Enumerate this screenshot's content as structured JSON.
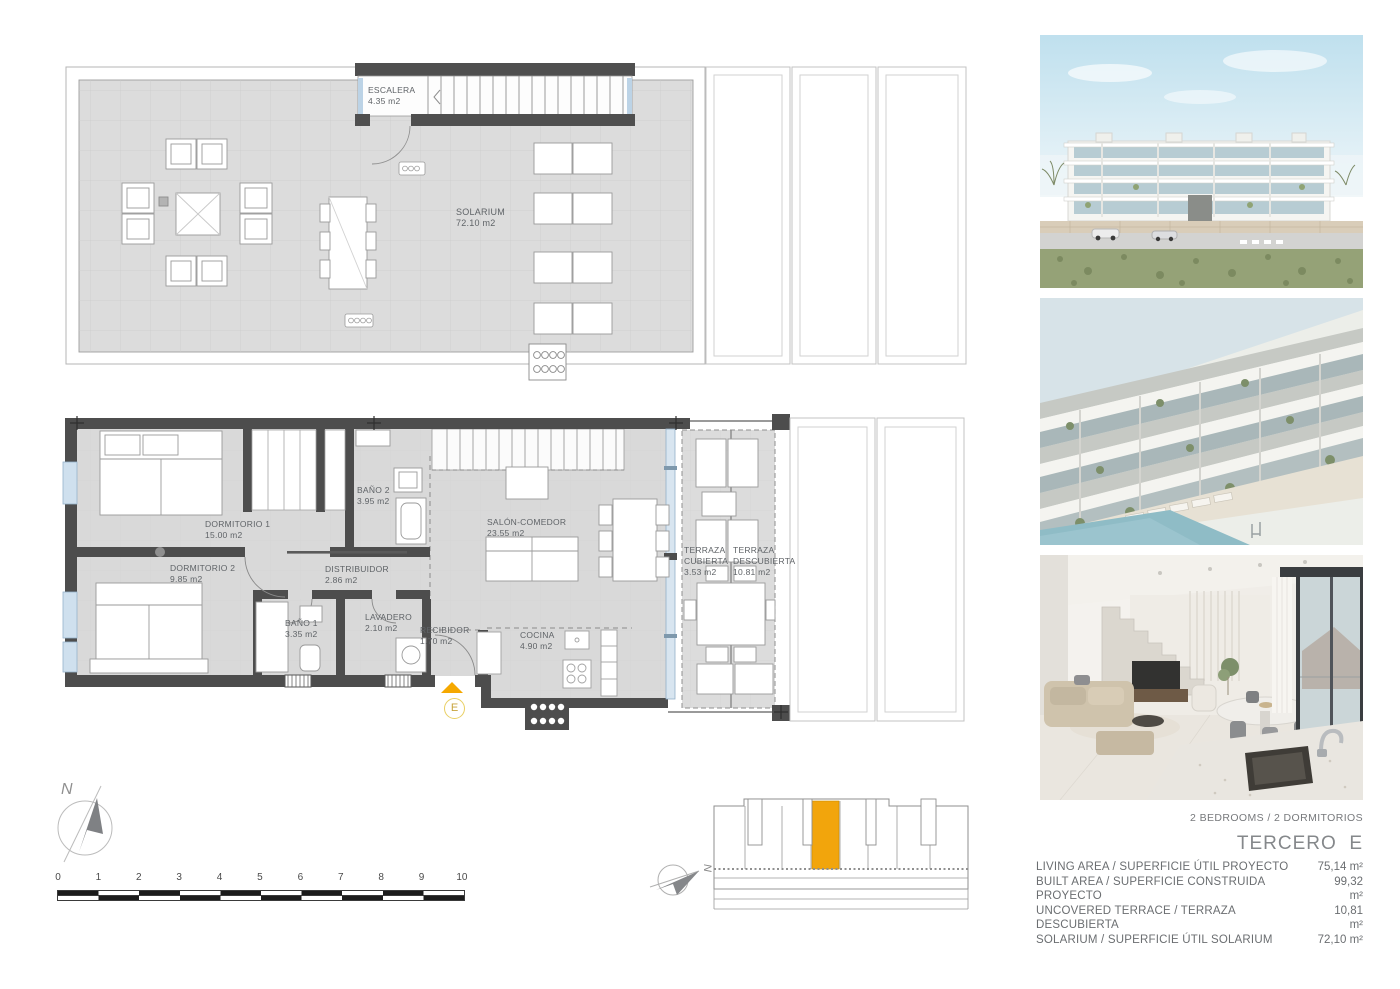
{
  "sheet": {
    "unit_type": "2 BEDROOMS / 2 DORMITORIOS",
    "title": "TERCERO  E",
    "specs": [
      {
        "label": "LIVING AREA / SUPERFICIE ÚTIL PROYECTO",
        "value": "75,14 m²"
      },
      {
        "label": "BUILT AREA / SUPERFICIE CONSTRUIDA PROYECTO",
        "value": "99,32 m²"
      },
      {
        "label": "UNCOVERED TERRACE / TERRAZA DESCUBIERTA",
        "value": "10,81 m²"
      },
      {
        "label": "SOLARIUM / SUPERFICIE ÚTIL SOLARIUM",
        "value": "72,10 m²"
      }
    ]
  },
  "solarium_plan": {
    "rooms": [
      {
        "name": "ESCALERA",
        "area": "4.35 m2"
      },
      {
        "name": "SOLARIUM",
        "area": "72.10 m2"
      }
    ]
  },
  "floor_plan": {
    "rooms": [
      {
        "name": "DORMITORIO 1",
        "area": "15.00 m2"
      },
      {
        "name": "DORMITORIO 2",
        "area": "9.85 m2"
      },
      {
        "name": "BAÑO 2",
        "area": "3.95 m2"
      },
      {
        "name": "DISTRIBUIDOR",
        "area": "2.86 m2"
      },
      {
        "name": "BAÑO 1",
        "area": "3.35 m2"
      },
      {
        "name": "LAVADERO",
        "area": "2.10 m2"
      },
      {
        "name": "RECIBIDOR",
        "area": "1.70 m2"
      },
      {
        "name": "SALÓN-COMEDOR",
        "area": "23.55 m2"
      },
      {
        "name": "COCINA",
        "area": "4.90 m2"
      },
      {
        "name": "TERRAZA CUBIERTA",
        "area": "3.53 m2"
      },
      {
        "name": "TERRAZA DESCUBIERTA",
        "area": "10.81 m2"
      }
    ],
    "entry_marker": "E"
  },
  "compass": {
    "label": "N"
  },
  "key_plan": {
    "compass_label": "N"
  },
  "scale_bar": {
    "ticks": [
      "0",
      "1",
      "2",
      "3",
      "4",
      "5",
      "6",
      "7",
      "8",
      "9",
      "10"
    ]
  },
  "photos": [
    {
      "name": "exterior-front-render"
    },
    {
      "name": "exterior-terraces-pool-render"
    },
    {
      "name": "interior-living-room-render"
    }
  ],
  "colors": {
    "accent_orange": "#F2A50C",
    "wall_dark": "#4D4D4D",
    "floor_gray": "#DBDBDB",
    "glass_blue": "#A9C7DE",
    "entry_yellow": "#E9CF63"
  }
}
